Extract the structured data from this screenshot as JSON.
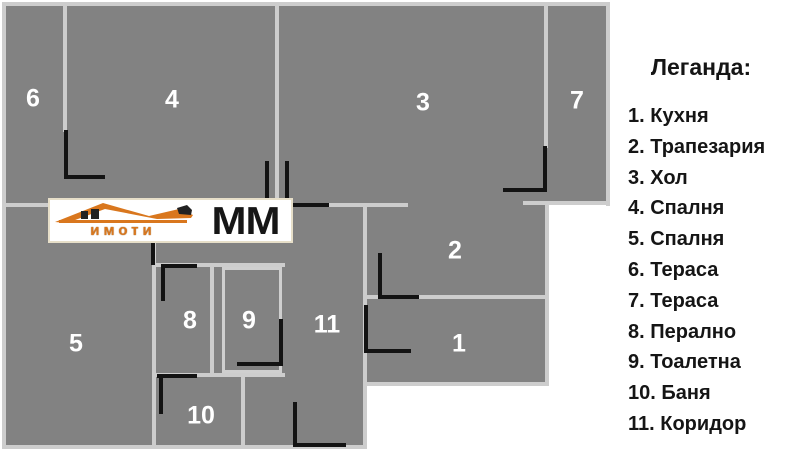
{
  "legend": {
    "title": "Леганда:"
  },
  "rooms": [
    {
      "number": "1",
      "name": "Кухня"
    },
    {
      "number": "2",
      "name": "Трапезария"
    },
    {
      "number": "3",
      "name": "Хол"
    },
    {
      "number": "4",
      "name": "Спалня"
    },
    {
      "number": "5",
      "name": "Спалня"
    },
    {
      "number": "6",
      "name": "Тераса"
    },
    {
      "number": "7",
      "name": "Тераса"
    },
    {
      "number": "8",
      "name": "Перално"
    },
    {
      "number": "9",
      "name": "Тоалетна"
    },
    {
      "number": "10",
      "name": "Баня"
    },
    {
      "number": "11",
      "name": "Коридор"
    }
  ],
  "logo": {
    "brand_text": "имоти",
    "brand_suffix": "MM"
  },
  "colors": {
    "plan_fill": "#828282",
    "wall_line": "#cdcdcd",
    "door_mark": "#131313",
    "logo_orange": "#d9771e",
    "room_label": "#ffffff",
    "legend_text": "#151515",
    "background": "#ffffff"
  }
}
